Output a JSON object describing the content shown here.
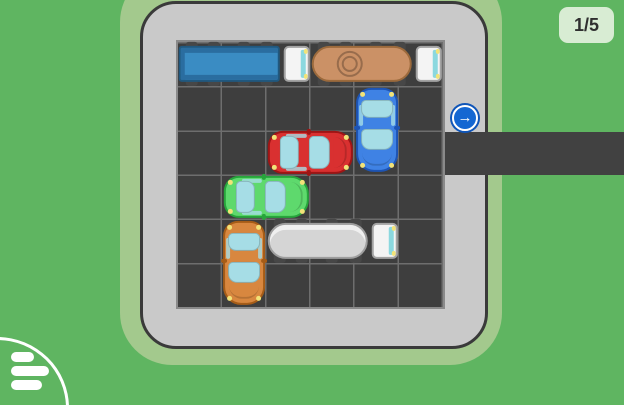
{
  "hud": {
    "level_indicator": "1/5",
    "menu_icon": "hamburger-menu-icon"
  },
  "board": {
    "rows": 6,
    "cols": 6,
    "exit": {
      "side": "right",
      "row": 2,
      "arrow_icon": "arrow-right-icon",
      "arrow_glyph": "→"
    }
  },
  "colors": {
    "background": "#5fb561",
    "frame": "#a3c98d",
    "board_surface": "#c9c9c9",
    "board_outline": "#3a3a3a",
    "grid_fill": "#3e3e3e",
    "grid_line": "#6e6e6e",
    "exit_road": "#414141",
    "arrow_blue": "#1467d2",
    "window_glass": "#a6dde6",
    "headlight": "#f2e378",
    "badge_bg": "#d8ecd3",
    "badge_text": "#2f2f2f"
  },
  "vehicles": [
    {
      "id": "blue-truck",
      "kind": "truck-box",
      "row": 0,
      "col": 0,
      "length": 3,
      "orientation": "horizontal",
      "facing": "east",
      "color": "#3a8cc3",
      "trim": "#2a6da0",
      "outline": "#20587f",
      "cap": false
    },
    {
      "id": "tan-tanker",
      "kind": "truck-tank",
      "row": 0,
      "col": 3,
      "length": 3,
      "orientation": "horizontal",
      "facing": "east",
      "color": "#cb9166",
      "outline": "#9c6a3c",
      "cap": true
    },
    {
      "id": "blue-car",
      "kind": "car",
      "row": 1,
      "col": 4,
      "length": 2,
      "orientation": "vertical",
      "facing": "south",
      "color": "#3f82e4",
      "outline": "#1d54b4"
    },
    {
      "id": "red-car",
      "kind": "car",
      "row": 2,
      "col": 2,
      "length": 2,
      "orientation": "horizontal",
      "facing": "east",
      "color": "#d93030",
      "outline": "#9e1515"
    },
    {
      "id": "green-car",
      "kind": "car",
      "row": 3,
      "col": 1,
      "length": 2,
      "orientation": "horizontal",
      "facing": "east",
      "color": "#5ed96d",
      "outline": "#27a53c"
    },
    {
      "id": "orange-car",
      "kind": "car",
      "row": 4,
      "col": 1,
      "length": 2,
      "orientation": "vertical",
      "facing": "south",
      "color": "#d8873f",
      "outline": "#a55c17"
    },
    {
      "id": "white-tanker",
      "kind": "truck-tank",
      "row": 4,
      "col": 2,
      "length": 3,
      "orientation": "horizontal",
      "facing": "east",
      "color": "#d5d5d5",
      "outline": "#9e9e9e",
      "cap": false,
      "highlight": "rgba(255,255,255,0.65)"
    }
  ]
}
